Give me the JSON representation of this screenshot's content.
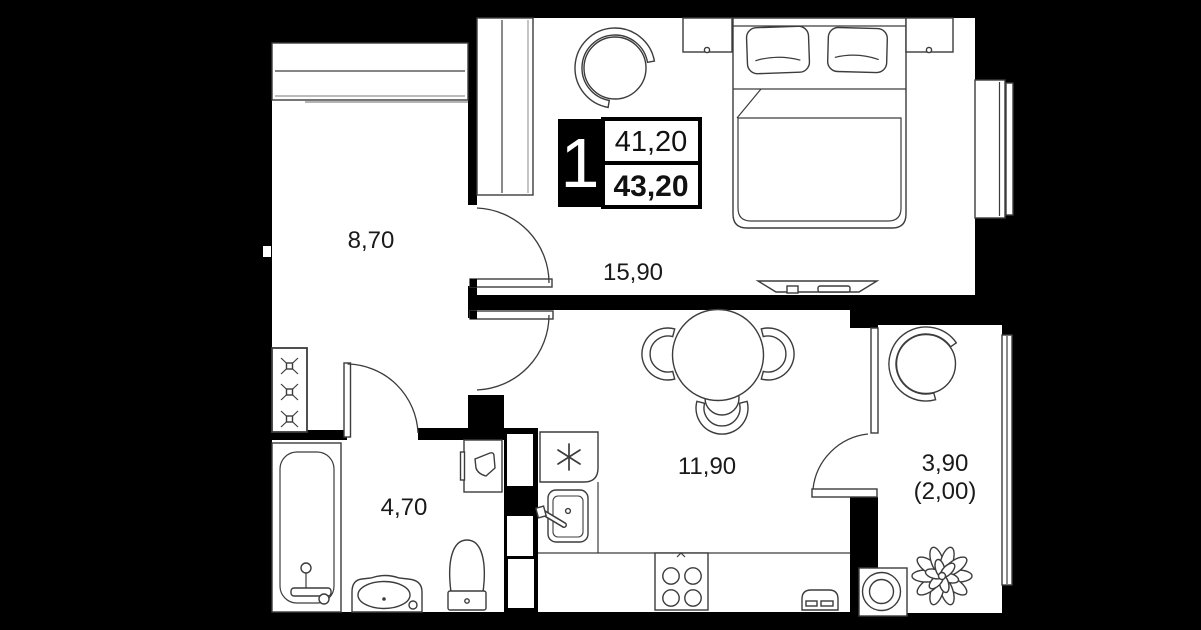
{
  "badge": {
    "rooms_count": "1",
    "area_living": "41,20",
    "area_total": "43,20"
  },
  "rooms": {
    "hall": {
      "area": "8,70"
    },
    "bedroom": {
      "area": "15,90"
    },
    "kitchen_living": {
      "area": "11,90"
    },
    "bathroom": {
      "area": "4,70"
    },
    "balcony": {
      "area": "3,90",
      "area_with_coefficient": "(2,00)"
    }
  },
  "colors": {
    "background": "#000000",
    "floor": "#ffffff",
    "outline": "#3c3c3c",
    "label_text": "#1a1a1a",
    "badge_box": "#000000"
  }
}
